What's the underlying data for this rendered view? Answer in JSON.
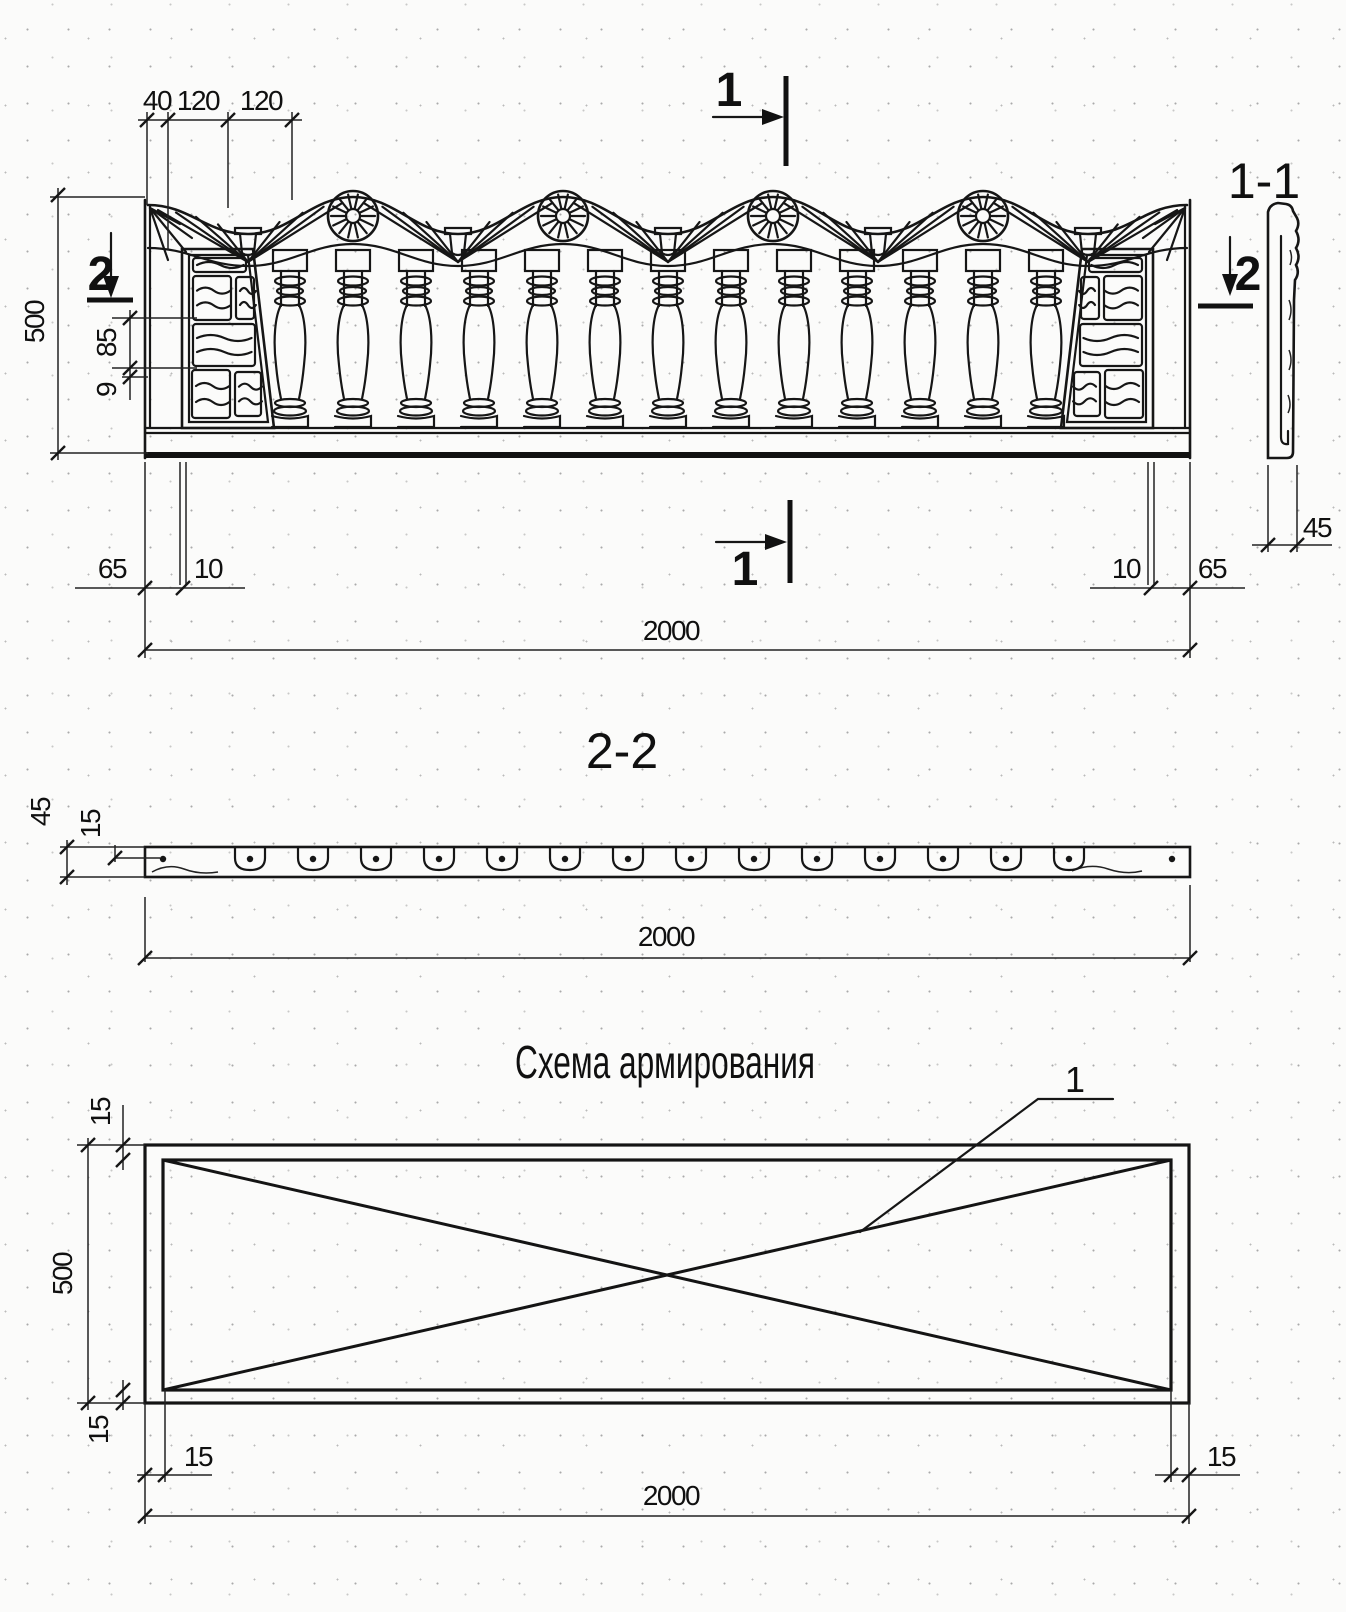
{
  "titles": {
    "scheme_title": "Схема армирования",
    "section11": "1-1",
    "section22": "2-2"
  },
  "marks": {
    "cut1": "1",
    "cut2": "2",
    "leader": "1"
  },
  "dims": {
    "d40": "40",
    "d120": "120",
    "d500": "500",
    "d85": "85",
    "d9": "9",
    "d65": "65",
    "d10": "10",
    "d2000": "2000",
    "d45": "45",
    "d15": "15"
  }
}
